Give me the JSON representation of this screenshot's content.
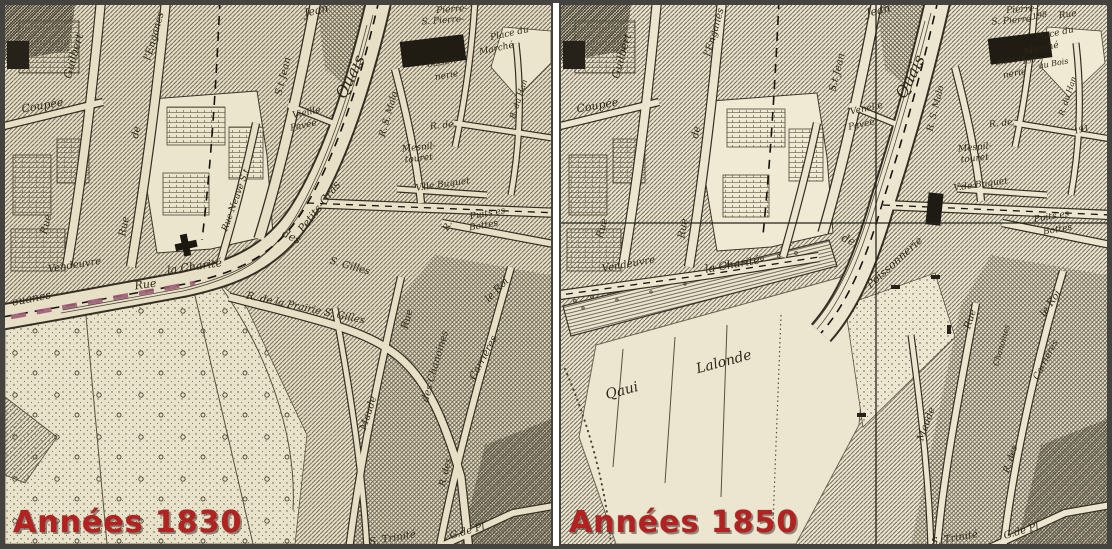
{
  "figure": {
    "type": "historical map comparison, city of Caen riverfront",
    "border_color": "#45433f",
    "gutter_color": "#ffffff",
    "caption_color": "#b32121",
    "ink_color": "#2e2717",
    "boundary_dash_color": "#9d5c78"
  },
  "panels": {
    "left": {
      "caption": "Années 1830",
      "paper_color": "#e7dfc6",
      "labels": [
        {
          "t": "Guilbert",
          "x": 72,
          "y": 52,
          "r": -74,
          "s": 11
        },
        {
          "t": "Coupée",
          "x": 38,
          "y": 104,
          "r": -10,
          "s": 11
        },
        {
          "t": "Rue",
          "x": 44,
          "y": 220,
          "r": -76,
          "s": 10
        },
        {
          "t": "Rue",
          "x": 122,
          "y": 222,
          "r": -80,
          "s": 10
        },
        {
          "t": "de",
          "x": 134,
          "y": 128,
          "r": -78,
          "s": 10
        },
        {
          "t": "l'Enganes",
          "x": 152,
          "y": 32,
          "r": -74,
          "s": 10
        },
        {
          "t": "Jean",
          "x": 312,
          "y": 9,
          "r": -14,
          "s": 11
        },
        {
          "t": "S.t Jean",
          "x": 281,
          "y": 72,
          "r": -76,
          "s": 10
        },
        {
          "t": "Rue Neuve S.t",
          "x": 233,
          "y": 196,
          "r": -70,
          "s": 9
        },
        {
          "t": "Vieille",
          "x": 302,
          "y": 110,
          "r": -12,
          "s": 9
        },
        {
          "t": "Pavée",
          "x": 299,
          "y": 123,
          "r": -12,
          "s": 9
        },
        {
          "t": "Quais",
          "x": 350,
          "y": 74,
          "r": -64,
          "s": 16
        },
        {
          "t": "Petits-Gras",
          "x": 317,
          "y": 204,
          "r": -52,
          "s": 11
        },
        {
          "t": "des",
          "x": 285,
          "y": 235,
          "r": 26,
          "s": 11
        },
        {
          "t": "S. Gilles",
          "x": 344,
          "y": 264,
          "r": 16,
          "s": 10
        },
        {
          "t": "la Charité",
          "x": 190,
          "y": 265,
          "r": -8,
          "s": 11
        },
        {
          "t": "Rue",
          "x": 141,
          "y": 283,
          "r": -8,
          "s": 11
        },
        {
          "t": "Vendeuvre",
          "x": 70,
          "y": 263,
          "r": -9,
          "s": 10
        },
        {
          "t": "ouanes",
          "x": 27,
          "y": 297,
          "r": -11,
          "s": 11
        },
        {
          "t": "R. de la Prairie S. Gilles",
          "x": 300,
          "y": 306,
          "r": 12,
          "s": 10
        },
        {
          "t": "Rue",
          "x": 405,
          "y": 315,
          "r": -74,
          "s": 10
        },
        {
          "t": "des Chanoines",
          "x": 433,
          "y": 362,
          "r": -74,
          "s": 10
        },
        {
          "t": "Carrières",
          "x": 481,
          "y": 354,
          "r": -62,
          "s": 10
        },
        {
          "t": "le Roi",
          "x": 494,
          "y": 287,
          "r": -46,
          "s": 10
        },
        {
          "t": "Maude",
          "x": 366,
          "y": 409,
          "r": -72,
          "s": 10
        },
        {
          "t": "R. des",
          "x": 443,
          "y": 468,
          "r": -76,
          "s": 9
        },
        {
          "t": "G.de Pl",
          "x": 463,
          "y": 529,
          "r": -16,
          "s": 10
        },
        {
          "t": "S. Trinité",
          "x": 388,
          "y": 536,
          "r": -10,
          "s": 10
        },
        {
          "t": "Pierre-",
          "x": 447,
          "y": 7,
          "r": -4,
          "s": 9
        },
        {
          "t": "S. Pierre-",
          "x": 438,
          "y": 18,
          "r": -4,
          "s": 9
        },
        {
          "t": "oisson",
          "x": 437,
          "y": 60,
          "r": -10,
          "s": 9
        },
        {
          "t": "nerie",
          "x": 442,
          "y": 73,
          "r": -10,
          "s": 9
        },
        {
          "t": "Place du",
          "x": 505,
          "y": 31,
          "r": -12,
          "s": 9
        },
        {
          "t": "Marché",
          "x": 492,
          "y": 46,
          "r": -12,
          "s": 9
        },
        {
          "t": "R. de",
          "x": 437,
          "y": 123,
          "r": -6,
          "s": 9
        },
        {
          "t": "Mesnil-",
          "x": 414,
          "y": 145,
          "r": -6,
          "s": 9
        },
        {
          "t": "touret",
          "x": 414,
          "y": 156,
          "r": -6,
          "s": 9
        },
        {
          "t": "R. S. Malo",
          "x": 386,
          "y": 110,
          "r": -74,
          "s": 9
        },
        {
          "t": "V.lle Buquet",
          "x": 438,
          "y": 182,
          "r": -8,
          "s": 9
        },
        {
          "t": "Puits es",
          "x": 483,
          "y": 211,
          "r": -10,
          "s": 9
        },
        {
          "t": "Bottes",
          "x": 479,
          "y": 223,
          "r": -10,
          "s": 9
        },
        {
          "t": "R.",
          "x": 445,
          "y": 222,
          "r": -62,
          "s": 9
        },
        {
          "t": "R. du Han",
          "x": 516,
          "y": 95,
          "r": -72,
          "s": 8
        }
      ]
    },
    "right": {
      "caption": "Années 1850",
      "paper_color": "#ece6d1",
      "labels": [
        {
          "t": "Guilbert",
          "x": 64,
          "y": 52,
          "r": -74,
          "s": 11
        },
        {
          "t": "Coupée",
          "x": 37,
          "y": 104,
          "r": -10,
          "s": 11
        },
        {
          "t": "Rue",
          "x": 44,
          "y": 224,
          "r": -74,
          "s": 10
        },
        {
          "t": "Rue",
          "x": 125,
          "y": 224,
          "r": -80,
          "s": 10
        },
        {
          "t": "de",
          "x": 138,
          "y": 128,
          "r": -78,
          "s": 10
        },
        {
          "t": "l'Enganes",
          "x": 156,
          "y": 28,
          "r": -74,
          "s": 10
        },
        {
          "t": "Jean",
          "x": 318,
          "y": 9,
          "r": -14,
          "s": 11
        },
        {
          "t": "S.t Jean",
          "x": 279,
          "y": 68,
          "r": -76,
          "s": 10
        },
        {
          "t": "Venelle",
          "x": 306,
          "y": 106,
          "r": -12,
          "s": 9
        },
        {
          "t": "Pavée",
          "x": 301,
          "y": 122,
          "r": -12,
          "s": 9
        },
        {
          "t": "Quais",
          "x": 354,
          "y": 74,
          "r": -64,
          "s": 16
        },
        {
          "t": "R. S. Malo",
          "x": 377,
          "y": 104,
          "r": -76,
          "s": 9
        },
        {
          "t": "Mesnil-",
          "x": 414,
          "y": 145,
          "r": -6,
          "s": 9
        },
        {
          "t": "touret",
          "x": 414,
          "y": 156,
          "r": -6,
          "s": 9
        },
        {
          "t": "R. de",
          "x": 440,
          "y": 121,
          "r": -6,
          "s": 9
        },
        {
          "t": "V.de Buquet",
          "x": 420,
          "y": 182,
          "r": -8,
          "s": 9
        },
        {
          "t": "de",
          "x": 286,
          "y": 238,
          "r": 24,
          "s": 11
        },
        {
          "t": "Poissonnerie",
          "x": 336,
          "y": 260,
          "r": -42,
          "s": 11
        },
        {
          "t": "la Charité",
          "x": 172,
          "y": 263,
          "r": -10,
          "s": 11
        },
        {
          "t": "Vendeuvre",
          "x": 68,
          "y": 262,
          "r": -10,
          "s": 10
        },
        {
          "t": "Qaui",
          "x": 62,
          "y": 390,
          "r": -15,
          "s": 14
        },
        {
          "t": "Lalonde",
          "x": 164,
          "y": 361,
          "r": -15,
          "s": 14
        },
        {
          "t": "Pierre-",
          "x": 461,
          "y": 7,
          "r": -4,
          "s": 9
        },
        {
          "t": "S. Pierre-",
          "x": 452,
          "y": 18,
          "r": -4,
          "s": 9
        },
        {
          "t": "oisson",
          "x": 449,
          "y": 58,
          "r": -10,
          "s": 9
        },
        {
          "t": "nerie",
          "x": 454,
          "y": 71,
          "r": -10,
          "s": 9
        },
        {
          "t": "198",
          "x": 479,
          "y": 13,
          "r": -10,
          "s": 8
        },
        {
          "t": "Rue",
          "x": 507,
          "y": 12,
          "r": -8,
          "s": 9
        },
        {
          "t": "Place du",
          "x": 494,
          "y": 31,
          "r": -12,
          "s": 9
        },
        {
          "t": "Marché",
          "x": 481,
          "y": 46,
          "r": -12,
          "s": 9
        },
        {
          "t": "197.",
          "x": 470,
          "y": 58,
          "r": -8,
          "s": 8
        },
        {
          "t": "au Bois",
          "x": 493,
          "y": 61,
          "r": -10,
          "s": 8
        },
        {
          "t": "191",
          "x": 521,
          "y": 127,
          "r": -14,
          "s": 8
        },
        {
          "t": "R. du Han",
          "x": 509,
          "y": 92,
          "r": -72,
          "s": 8
        },
        {
          "t": "Puits es",
          "x": 491,
          "y": 214,
          "r": -10,
          "s": 9
        },
        {
          "t": "Bottes",
          "x": 497,
          "y": 227,
          "r": -10,
          "s": 9
        },
        {
          "t": "Rue",
          "x": 412,
          "y": 315,
          "r": -72,
          "s": 10
        },
        {
          "t": "Chanoines",
          "x": 443,
          "y": 341,
          "r": -74,
          "s": 8
        },
        {
          "t": "le Roi",
          "x": 492,
          "y": 300,
          "r": -56,
          "s": 10
        },
        {
          "t": "Carrières",
          "x": 487,
          "y": 356,
          "r": -62,
          "s": 9
        },
        {
          "t": "Maude",
          "x": 368,
          "y": 420,
          "r": -70,
          "s": 10
        },
        {
          "t": "R. des",
          "x": 452,
          "y": 455,
          "r": -72,
          "s": 9
        },
        {
          "t": "G.de Pl",
          "x": 461,
          "y": 529,
          "r": -16,
          "s": 10
        },
        {
          "t": "S. Trinité",
          "x": 394,
          "y": 536,
          "r": -10,
          "s": 10
        }
      ]
    }
  }
}
